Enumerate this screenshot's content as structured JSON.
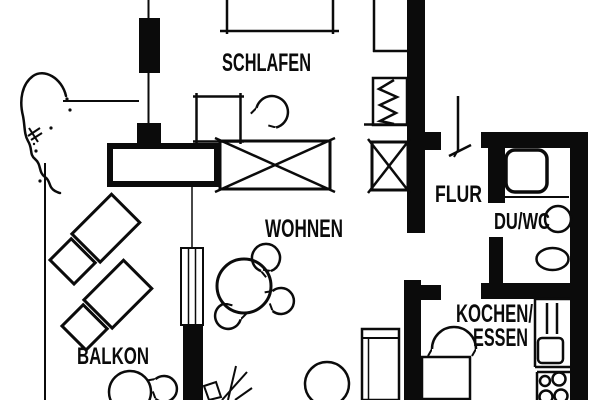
{
  "plan": {
    "background": "#ffffff",
    "ink": "#0b0b0b",
    "rooms": {
      "schlafen": "SCHLAFEN",
      "wohnen": "WOHNEN",
      "balkon": "BALKON",
      "flur": "FLUR",
      "du_wc": "DU/WC",
      "kochen_line1": "KOCHEN/",
      "kochen_line2": "ESSEN"
    },
    "symbols": {
      "entrance_arrow": "down-arrow",
      "door_swing": "arc-with-arrowheads",
      "closet": "x-crossed-box",
      "radiator": "zigzag-box",
      "section_mark": "filled-bar-line"
    }
  }
}
